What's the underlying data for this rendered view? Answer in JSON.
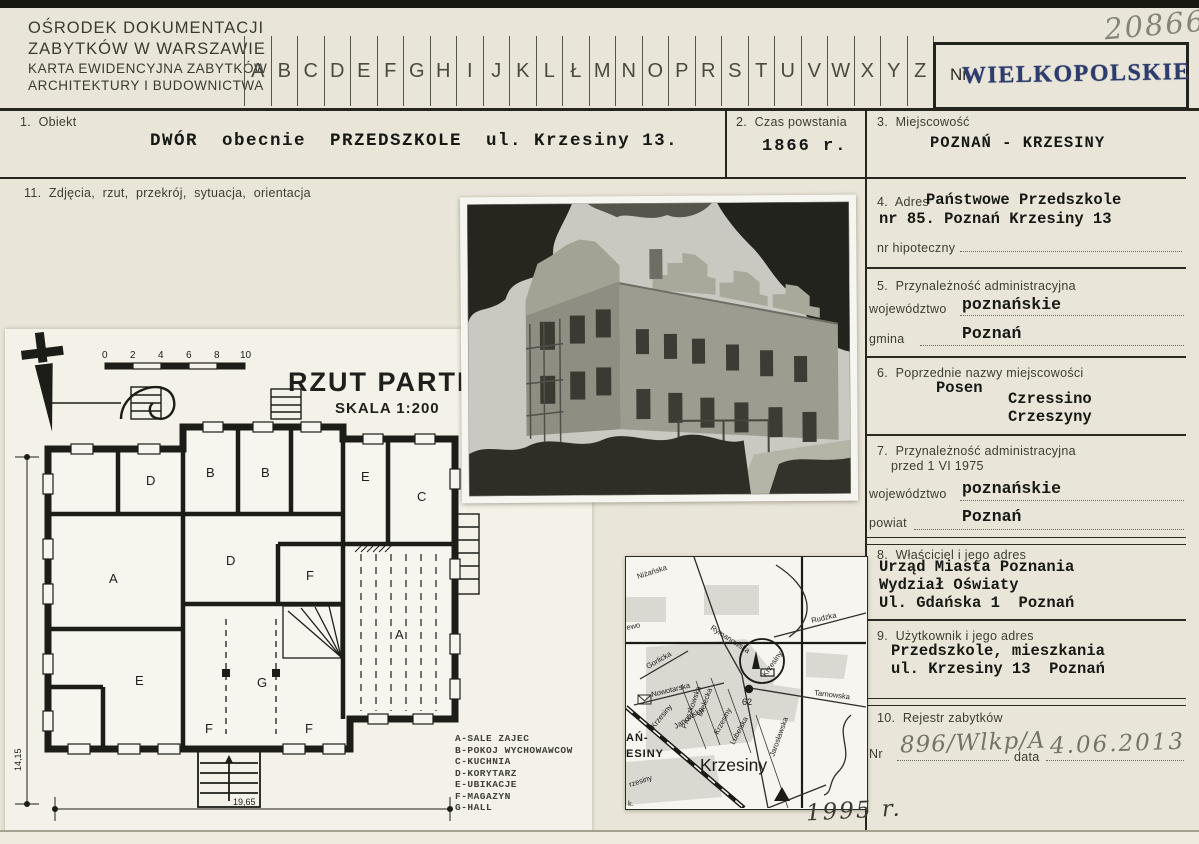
{
  "header": {
    "org_line1": "OŚRODEK DOKUMENTACJI",
    "org_line2": "ZABYTKÓW W WARSZAWIE",
    "org_line3": "KARTA EWIDENCYJNA ZABYTKÓW",
    "org_line4": "ARCHITEKTURY I BUDOWNICTWA",
    "alphabet": [
      "A",
      "B",
      "C",
      "D",
      "E",
      "F",
      "G",
      "H",
      "I",
      "J",
      "K",
      "L",
      "Ł",
      "M",
      "N",
      "O",
      "P",
      "R",
      "S",
      "T",
      "U",
      "V",
      "W",
      "X",
      "Y",
      "Z"
    ],
    "handwritten_number": "20866",
    "stamp": {
      "prefix": "Nr",
      "text": "WIELKOPOLSKIE",
      "color": "#2e3b6d"
    }
  },
  "fields": {
    "f1": {
      "label": "1.  Obiekt",
      "value": "DWÓR  obecnie  PRZEDSZKOLE  ul. Krzesiny 13."
    },
    "f2": {
      "label": "2.  Czas powstania",
      "value": "1866 r."
    },
    "f3": {
      "label": "3.  Miejscowość",
      "value": "POZNAŃ - KRZESINY"
    },
    "f4": {
      "label": "4.  Adres",
      "line1": "Państwowe Przedszkole",
      "line2": "nr 85. Poznań Krzesiny 13",
      "sub_label": "nr hipoteczny"
    },
    "f5": {
      "label": "5.  Przynależność administracyjna",
      "row1_label": "województwo",
      "row1_value": "poznańskie",
      "row2_label": "gmina",
      "row2_value": "Poznań"
    },
    "f6": {
      "label": "6.  Poprzednie nazwy miejscowości",
      "value1": "Posen",
      "value2": "Czressino",
      "value3": "Crzeszyny"
    },
    "f7": {
      "label_line1": "7.  Przynależność administracyjna",
      "label_line2": "przed 1 VI 1975",
      "row1_label": "województwo",
      "row1_value": "poznańskie",
      "row2_label": "powiat",
      "row2_value": "Poznań"
    },
    "f8": {
      "label": "8.  Właściciel i jego adres",
      "line1": "Urząd Miasta Poznania",
      "line2": "Wydział Oświaty",
      "line3": "Ul. Gdańska 1  Poznań"
    },
    "f9": {
      "label": "9.  Użytkownik i jego adres",
      "line1": "Przedszkole, mieszkania",
      "line2": "ul. Krzesiny 13  Poznań"
    },
    "f10": {
      "label": "10.  Rejestr zabytków",
      "nr_label": "Nr",
      "nr_value": "896/Wlkp/A",
      "date_label": "data",
      "date_value": "4.06.2013"
    },
    "f11": {
      "label": "11.  Zdjęcia,  rzut,  przekrój,  sytuacja,  orientacja"
    }
  },
  "plan": {
    "title": "RZUT PARTERU",
    "scale": "SKALA  1:200",
    "scale_ticks": [
      "0",
      "2",
      "4",
      "6",
      "8",
      "10"
    ],
    "room_labels": [
      "D",
      "B",
      "B",
      "E",
      "C",
      "A",
      "D",
      "F",
      "G",
      "A",
      "E",
      "F",
      "F"
    ],
    "legend": [
      "A-SALE ZAJEC",
      "B-POKOJ WYCHOWAWCOW",
      "C-KUCHNIA",
      "D-KORYTARZ",
      "E-UBIKACJE",
      "F-MAGAZYN",
      "G-HALL"
    ],
    "dim_height": "14,15",
    "dim_width": "19,65"
  },
  "map": {
    "big_label": "Krzesiny",
    "stop_number": "62",
    "year_note": "1995 r.",
    "partial_label_line1": "AŃ-",
    "partial_label_line2": "ESINY",
    "corner_label": "k.",
    "streets": {
      "nizanska": "Niżańska",
      "ewo": "ewo",
      "gorlicka": "Gorlicka",
      "rymanowska": "Rymanowska",
      "krzesiny_circle": "Krzesiny",
      "rudzka": "Rudzka",
      "tarnowska": "Tarnowska",
      "nowotarska": "Nowotarska",
      "pruszkowska": "Pruszkowska",
      "mielecka": "Mielecka",
      "janowska": "Janowska",
      "krzesiny_street": "Krzesiny",
      "lubelska": "Lubelska",
      "jaroslawska": "Jarosławska",
      "krzesiny_rail": "Krzesiny",
      "rzesiny_partial": "rzesiny",
      "k_partial": "k."
    }
  }
}
